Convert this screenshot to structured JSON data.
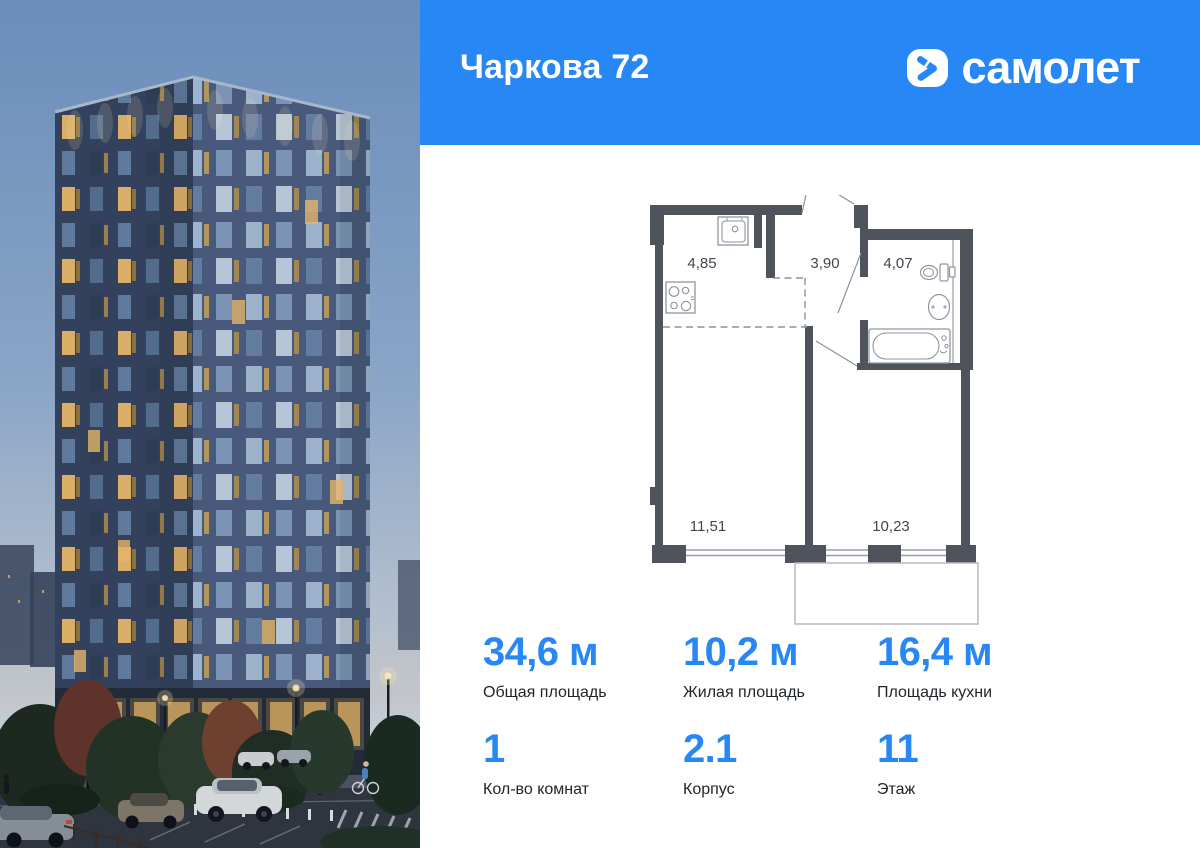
{
  "header": {
    "title": "Чаркова 72",
    "brand": "самолет",
    "bg_color": "#2787f5",
    "logo_icon": "samolet-chevron-icon"
  },
  "floor_plan": {
    "room_areas": {
      "kitchen": "4,85",
      "hall": "3,90",
      "bath": "4,07",
      "living": "11,51",
      "bedroom": "10,23"
    }
  },
  "stats": {
    "accent_color": "#2787f5",
    "total_area": {
      "value": "34,6 м",
      "label": "Общая площадь"
    },
    "living_area": {
      "value": "10,2 м",
      "label": "Жилая площадь"
    },
    "kitchen_area": {
      "value": "16,4 м",
      "label": "Площадь кухни"
    },
    "rooms": {
      "value": "1",
      "label": "Кол-во комнат"
    },
    "building": {
      "value": "2.1",
      "label": "Корпус"
    },
    "floor": {
      "value": "11",
      "label": "Этаж"
    }
  }
}
